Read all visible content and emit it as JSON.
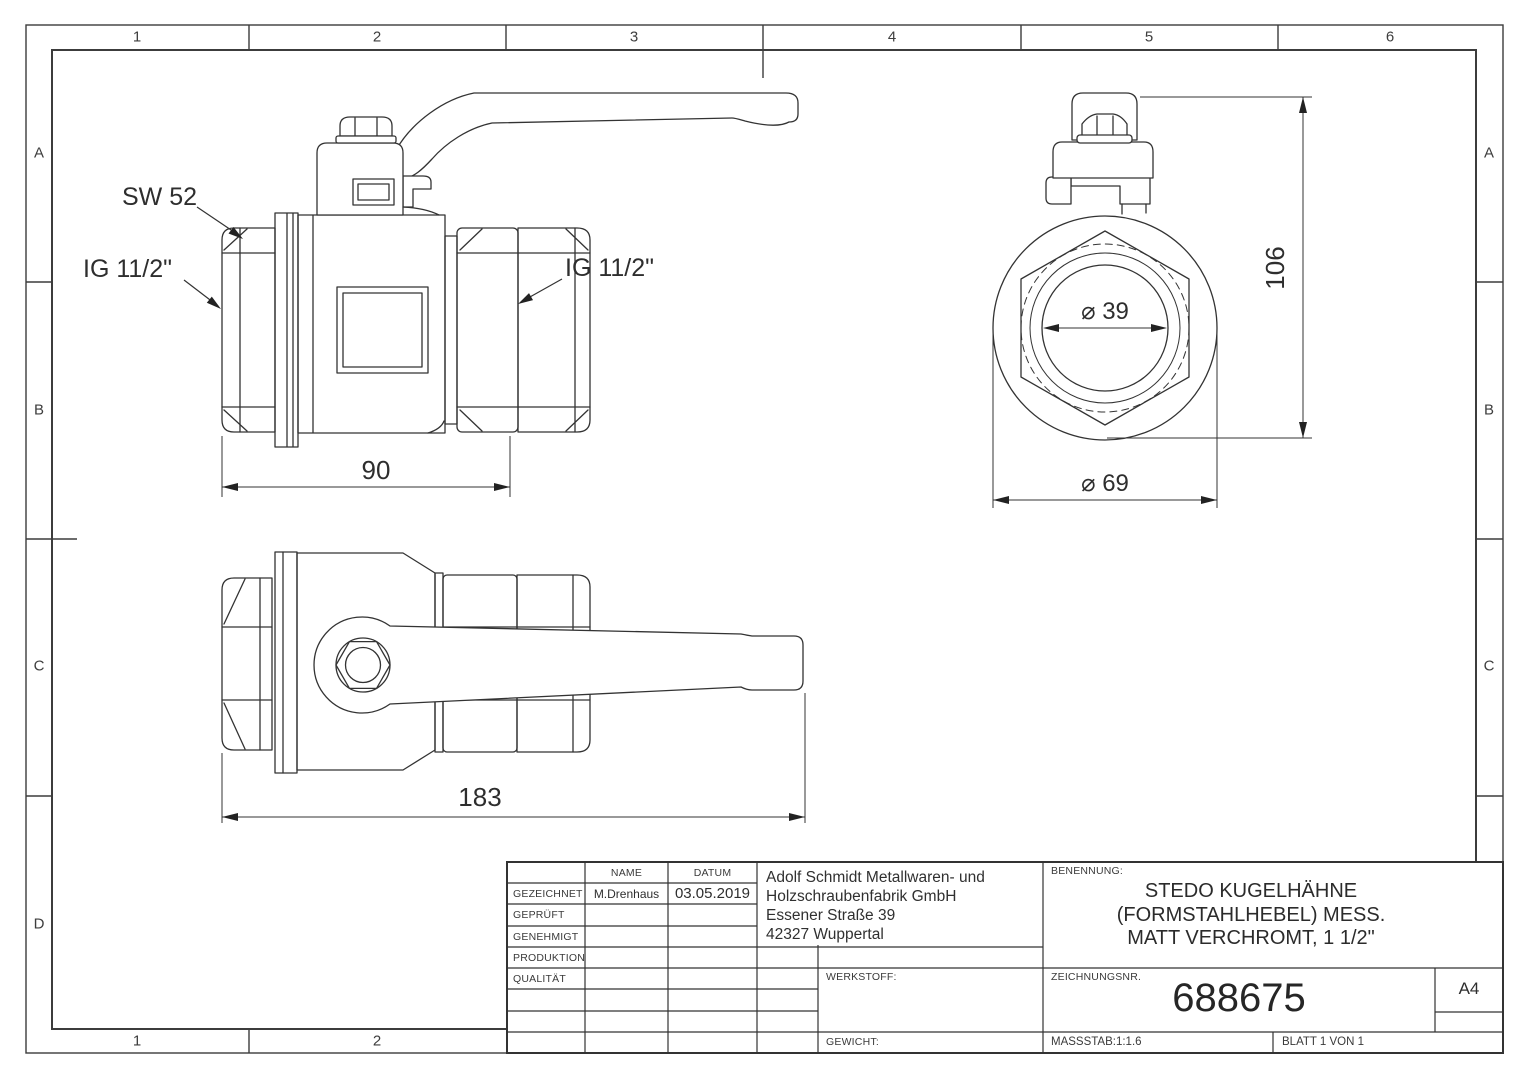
{
  "sheet": {
    "cols_top": [
      "1",
      "2",
      "3",
      "4",
      "5",
      "6"
    ],
    "cols_bottom": [
      "1",
      "2"
    ],
    "rows_left": [
      "A",
      "B",
      "C",
      "D"
    ],
    "rows_right": [
      "A",
      "B",
      "C"
    ],
    "format": "A4"
  },
  "views": {
    "front": {
      "label_sw": "SW 52",
      "label_ig_left": "IG 11/2\"",
      "label_ig_right": "IG 11/2\"",
      "dim_width": "90"
    },
    "top": {
      "dim_length": "183"
    },
    "end": {
      "dim_height": "106",
      "dim_bore": "⌀ 39",
      "dim_outer": "⌀ 69"
    }
  },
  "title_block": {
    "headers": {
      "name": "NAME",
      "date": "DATUM"
    },
    "rows": {
      "gezeichnet": {
        "label": "GEZEICHNET",
        "name": "M.Drenhaus",
        "date": "03.05.2019"
      },
      "geprueft": {
        "label": "GEPRÜFT"
      },
      "genehmigt": {
        "label": "GENEHMIGT"
      },
      "produktion": {
        "label": "PRODUKTION"
      },
      "qualitaet": {
        "label": "QUALITÄT"
      }
    },
    "company": {
      "line1": "Adolf Schmidt Metallwaren- und",
      "line2": "Holzschraubenfabrik GmbH",
      "line3": "Essener Straße 39",
      "line4": "42327 Wuppertal"
    },
    "werkstoff_label": "WERKSTOFF:",
    "gewicht_label": "GEWICHT:",
    "benennung_label": "BENENNUNG:",
    "benennung": {
      "line1": "STEDO KUGELHÄHNE",
      "line2": "(FORMSTAHLHEBEL) MESS.",
      "line3": "MATT VERCHROMT, 1 1/2\""
    },
    "zeichnungsnr_label": "ZEICHNUNGSNR.",
    "zeichnungsnr": "688675",
    "massstab": "MASSSTAB:1:1.6",
    "blatt": "BLATT 1 VON 1"
  },
  "colors": {
    "line": "#333333",
    "text": "#2e2e2e",
    "background": "#ffffff"
  }
}
